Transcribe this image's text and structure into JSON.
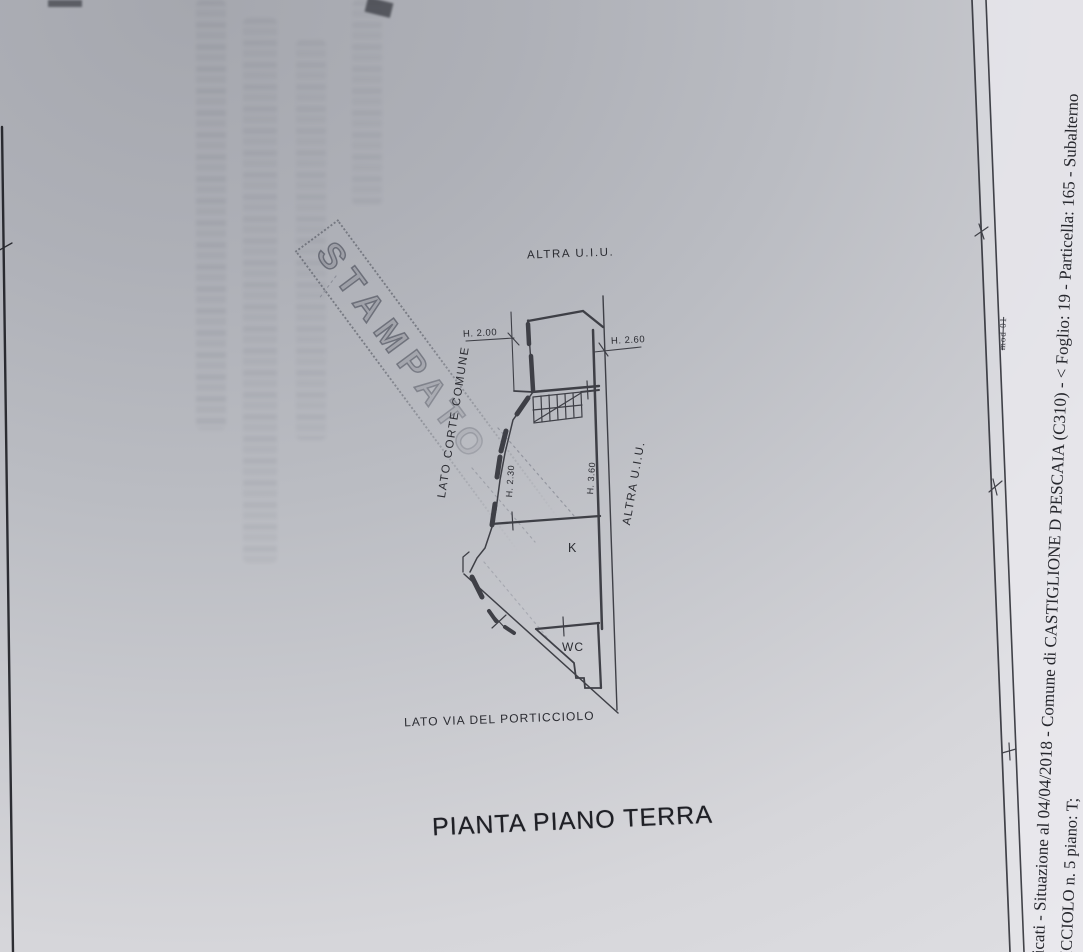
{
  "document": {
    "title": "PIANTA PIANO TERRA",
    "stamp_text": "STAMPATO",
    "margin": {
      "line_a": "bricati - Situazione al 04/04/2018 - Comune di CASTIGLIONE D PESCAIA (C310) - < Foglio: 19 - Particella: 165 - Subalterno",
      "line_b": "TICCIOLO n. 5 piano: T;",
      "mod_label": "mod 01"
    },
    "plan": {
      "altra_uiu_top": "ALTRA U.I.U.",
      "altra_uiu_right": "ALTRA U.I.U.",
      "lato_corte": "LATO CORTE COMUNE",
      "lato_via": "LATO VIA DEL PORTICCIOLO",
      "room_k": "K",
      "room_wc": "WC",
      "dim_h200": "H. 2.00",
      "dim_h260": "H. 2.60",
      "dim_h230": "H. 2.30",
      "dim_h360": "H. 3.60"
    },
    "colors": {
      "paper_dark": "#a5a7ae",
      "paper_light": "#dedee2",
      "ink": "#34353c",
      "stamp_ink": "#3c4050"
    }
  }
}
